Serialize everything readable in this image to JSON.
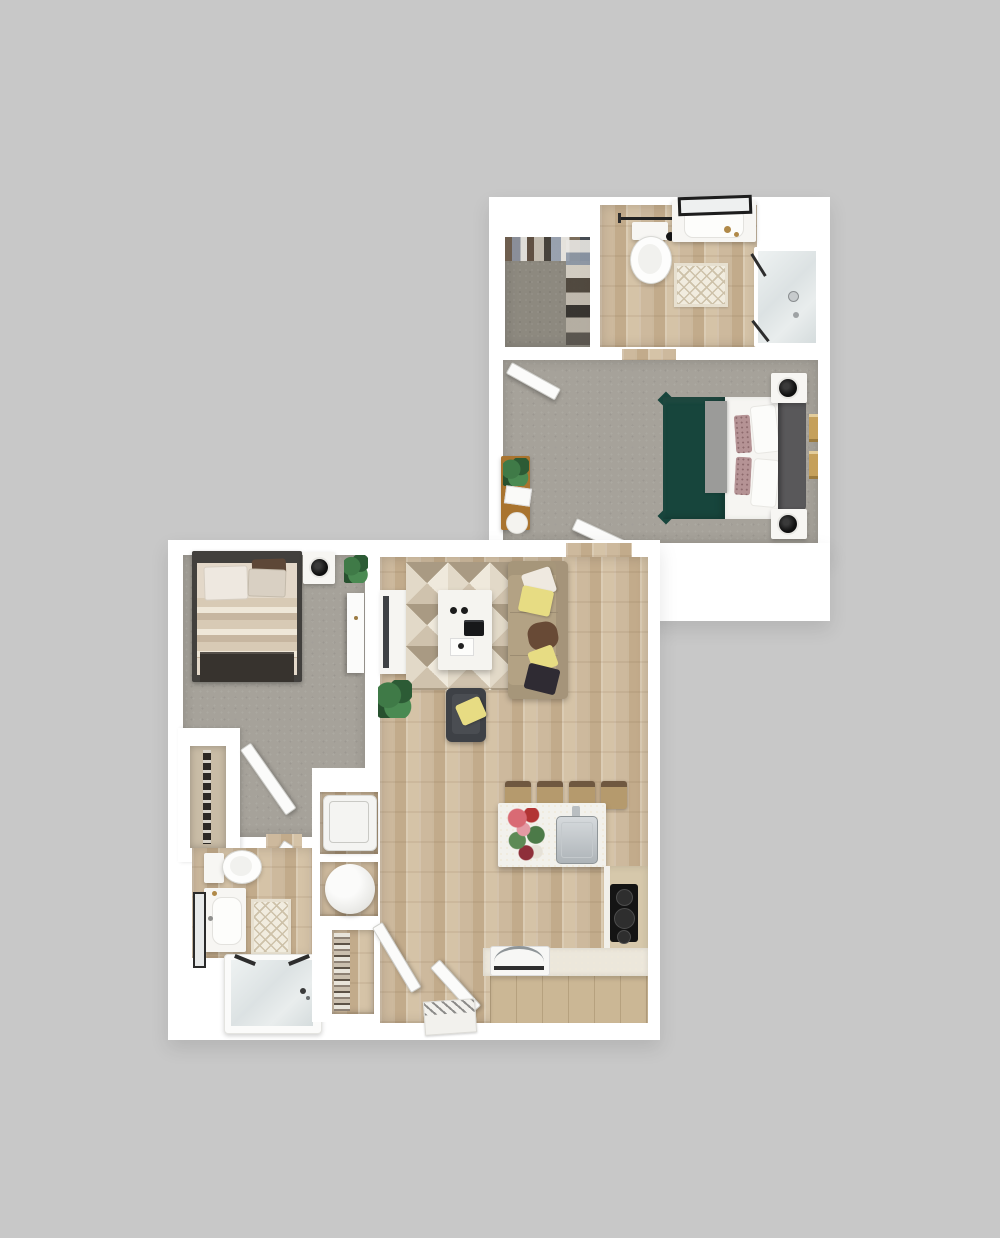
{
  "scene": {
    "type": "3D rendered apartment floor plan, top-down view, no text labels",
    "background": "gray matte backdrop",
    "units": [
      {
        "name": "bedroom-suite-upper-right",
        "rooms": [
          {
            "name": "walk-in-closet",
            "floor": "carpet",
            "furniture": [
              "hanging-clothes"
            ]
          },
          {
            "name": "bathroom",
            "floor": "wood",
            "furniture": [
              "towel-bar",
              "toilet",
              "vanity-sink",
              "leaning-mirror",
              "brass-accessories",
              "bath-mat",
              "walk-in-shower"
            ]
          },
          {
            "name": "bedroom",
            "floor": "carpet",
            "furniture": [
              "bed-green-duvet",
              "gray-throw",
              "white-sheets",
              "print-pillows",
              "white-pillows",
              "headboard",
              "wall-art-pair",
              "nightstand-with-lamp-top",
              "nightstand-with-lamp-bottom",
              "wood-desk",
              "desk-plant",
              "laptop",
              "round-tray",
              "open-door-top",
              "open-door-bottom"
            ]
          }
        ]
      },
      {
        "name": "one-bedroom-apartment-lower-left",
        "rooms": [
          {
            "name": "bedroom",
            "floor": "carpet",
            "furniture": [
              "bed-neutral-striped-duvet",
              "white-pillow",
              "tan-pillow",
              "brown-pillow",
              "dark-foot-throw",
              "nightstand-with-lamp",
              "corner-plant",
              "tall-dresser",
              "reach-in-closet",
              "open-door"
            ]
          },
          {
            "name": "bathroom",
            "floor": "wood",
            "furniture": [
              "toilet",
              "vanity-sink",
              "leaning-mirror",
              "bath-mat",
              "glass-tub-shower",
              "open-door"
            ]
          },
          {
            "name": "utility-column",
            "furniture": [
              "washer",
              "water-heater",
              "linen-shelves",
              "open-door"
            ]
          },
          {
            "name": "living-room",
            "floor": "wood",
            "furniture": [
              "media-console-tv",
              "geometric-rug",
              "coffee-table",
              "remotes",
              "media-box",
              "tray",
              "sofa",
              "pillow-white",
              "pillow-yellow",
              "pillow-brown",
              "pillow-yellow-2",
              "pillow-dark",
              "armchair",
              "armchair-pillow-yellow",
              "floor-plant"
            ]
          },
          {
            "name": "kitchen-entry",
            "floor": "wood",
            "furniture": [
              "island",
              "flower-vase",
              "island-sink-chrome",
              "faucet",
              "bar-stool-1",
              "bar-stool-2",
              "bar-stool-3",
              "bar-stool-4",
              "l-counter",
              "cooktop",
              "oven-with-handle",
              "entry-doormat",
              "entry-door",
              "hall-door"
            ]
          }
        ]
      }
    ]
  },
  "palette": {
    "background": "#c8c8c8",
    "wall": "#ffffff",
    "carpet": "#a6a29a",
    "carpet_dark": "#8d897f",
    "wood": "#cdb99d",
    "wood_deep": "#c2ab8b",
    "duvet_green": "#17453c",
    "headboard": "#59585a",
    "sheet": "#f6f5f2",
    "blanket": "#9b9b99",
    "pillow_mauve": "#b59395",
    "bed_frame": "#42403d",
    "foot_dark": "#37332e",
    "sofa": "#b3a284",
    "sofa_trim": "#a5947a",
    "pillow_yellow": "#e7dc83",
    "pillow_brown": "#684a36",
    "pillow_dark": "#2f2b33",
    "armchair": "#3e4146",
    "desk_wood": "#a9742f",
    "cabinet_tan": "#cbb795",
    "counter_light": "#ece7db",
    "cooktop": "#141414",
    "stool": "#b59a6d",
    "stool_trim": "#6f5840",
    "glass": "#dce2e3",
    "mat": "#f1ecdf",
    "plant": "#3f7a47",
    "brass": "#b08948",
    "chrome": "#c9cdd0"
  }
}
